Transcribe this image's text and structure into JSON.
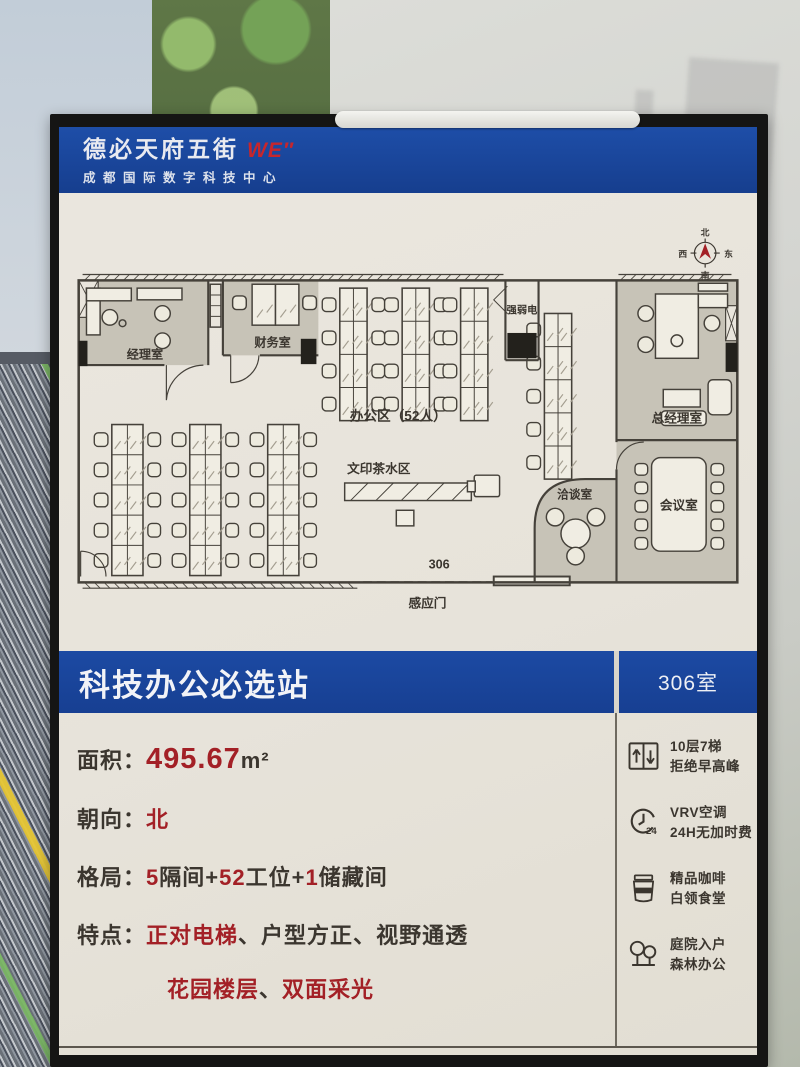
{
  "header": {
    "brand": "德必天府五街",
    "brand_mark": "WE″",
    "subtitle": "成都国际数字科技中心"
  },
  "floorplan": {
    "compass": {
      "north": "北",
      "east": "东",
      "south": "南",
      "west": "西"
    },
    "rooms": {
      "manager": "经理室",
      "finance": "财务室",
      "utility": "强弱电",
      "gm": "总经理室",
      "meeting": "会议室",
      "negotiation": "洽谈室"
    },
    "areas": {
      "open_office": "办公区（52人）",
      "print_tea": "文印茶水区"
    },
    "room_number": "306",
    "entrance": "感应门"
  },
  "title_bar": {
    "title": "科技办公必选站",
    "room": "306室"
  },
  "specs": {
    "area": {
      "label": "面积：",
      "value": "495.67",
      "unit": "m²"
    },
    "facing": {
      "label": "朝向：",
      "value": "北"
    },
    "layout": {
      "label": "格局：",
      "n1": "5",
      "t1": "隔间+",
      "n2": "52",
      "t2": "工位+",
      "n3": "1",
      "t3": "储藏间"
    },
    "features": {
      "label": "特点：",
      "hl1": "正对电梯",
      "sep1": "、",
      "p1": "户型方正",
      "sep2": "、",
      "p2": "视野通透",
      "hl2": "花园楼层",
      "sep3": "、",
      "hl3": "双面采光"
    }
  },
  "amenities": [
    {
      "icon": "elevator-icon",
      "line1": "10层7梯",
      "line2": "拒绝早高峰"
    },
    {
      "icon": "clock-24-icon",
      "icon_text": "24",
      "line1": "VRV空调",
      "line2": "24H无加时费"
    },
    {
      "icon": "coffee-icon",
      "icon_text": "COFFEE",
      "line1": "精品咖啡",
      "line2": "白领食堂"
    },
    {
      "icon": "trees-icon",
      "line1": "庭院入户",
      "line2": "森林办公"
    }
  ],
  "colors": {
    "brand_blue": "#1b48a1",
    "accent_red": "#a32026",
    "poster_cream": "#e9e5dc",
    "wall_dark": "#45413a"
  }
}
